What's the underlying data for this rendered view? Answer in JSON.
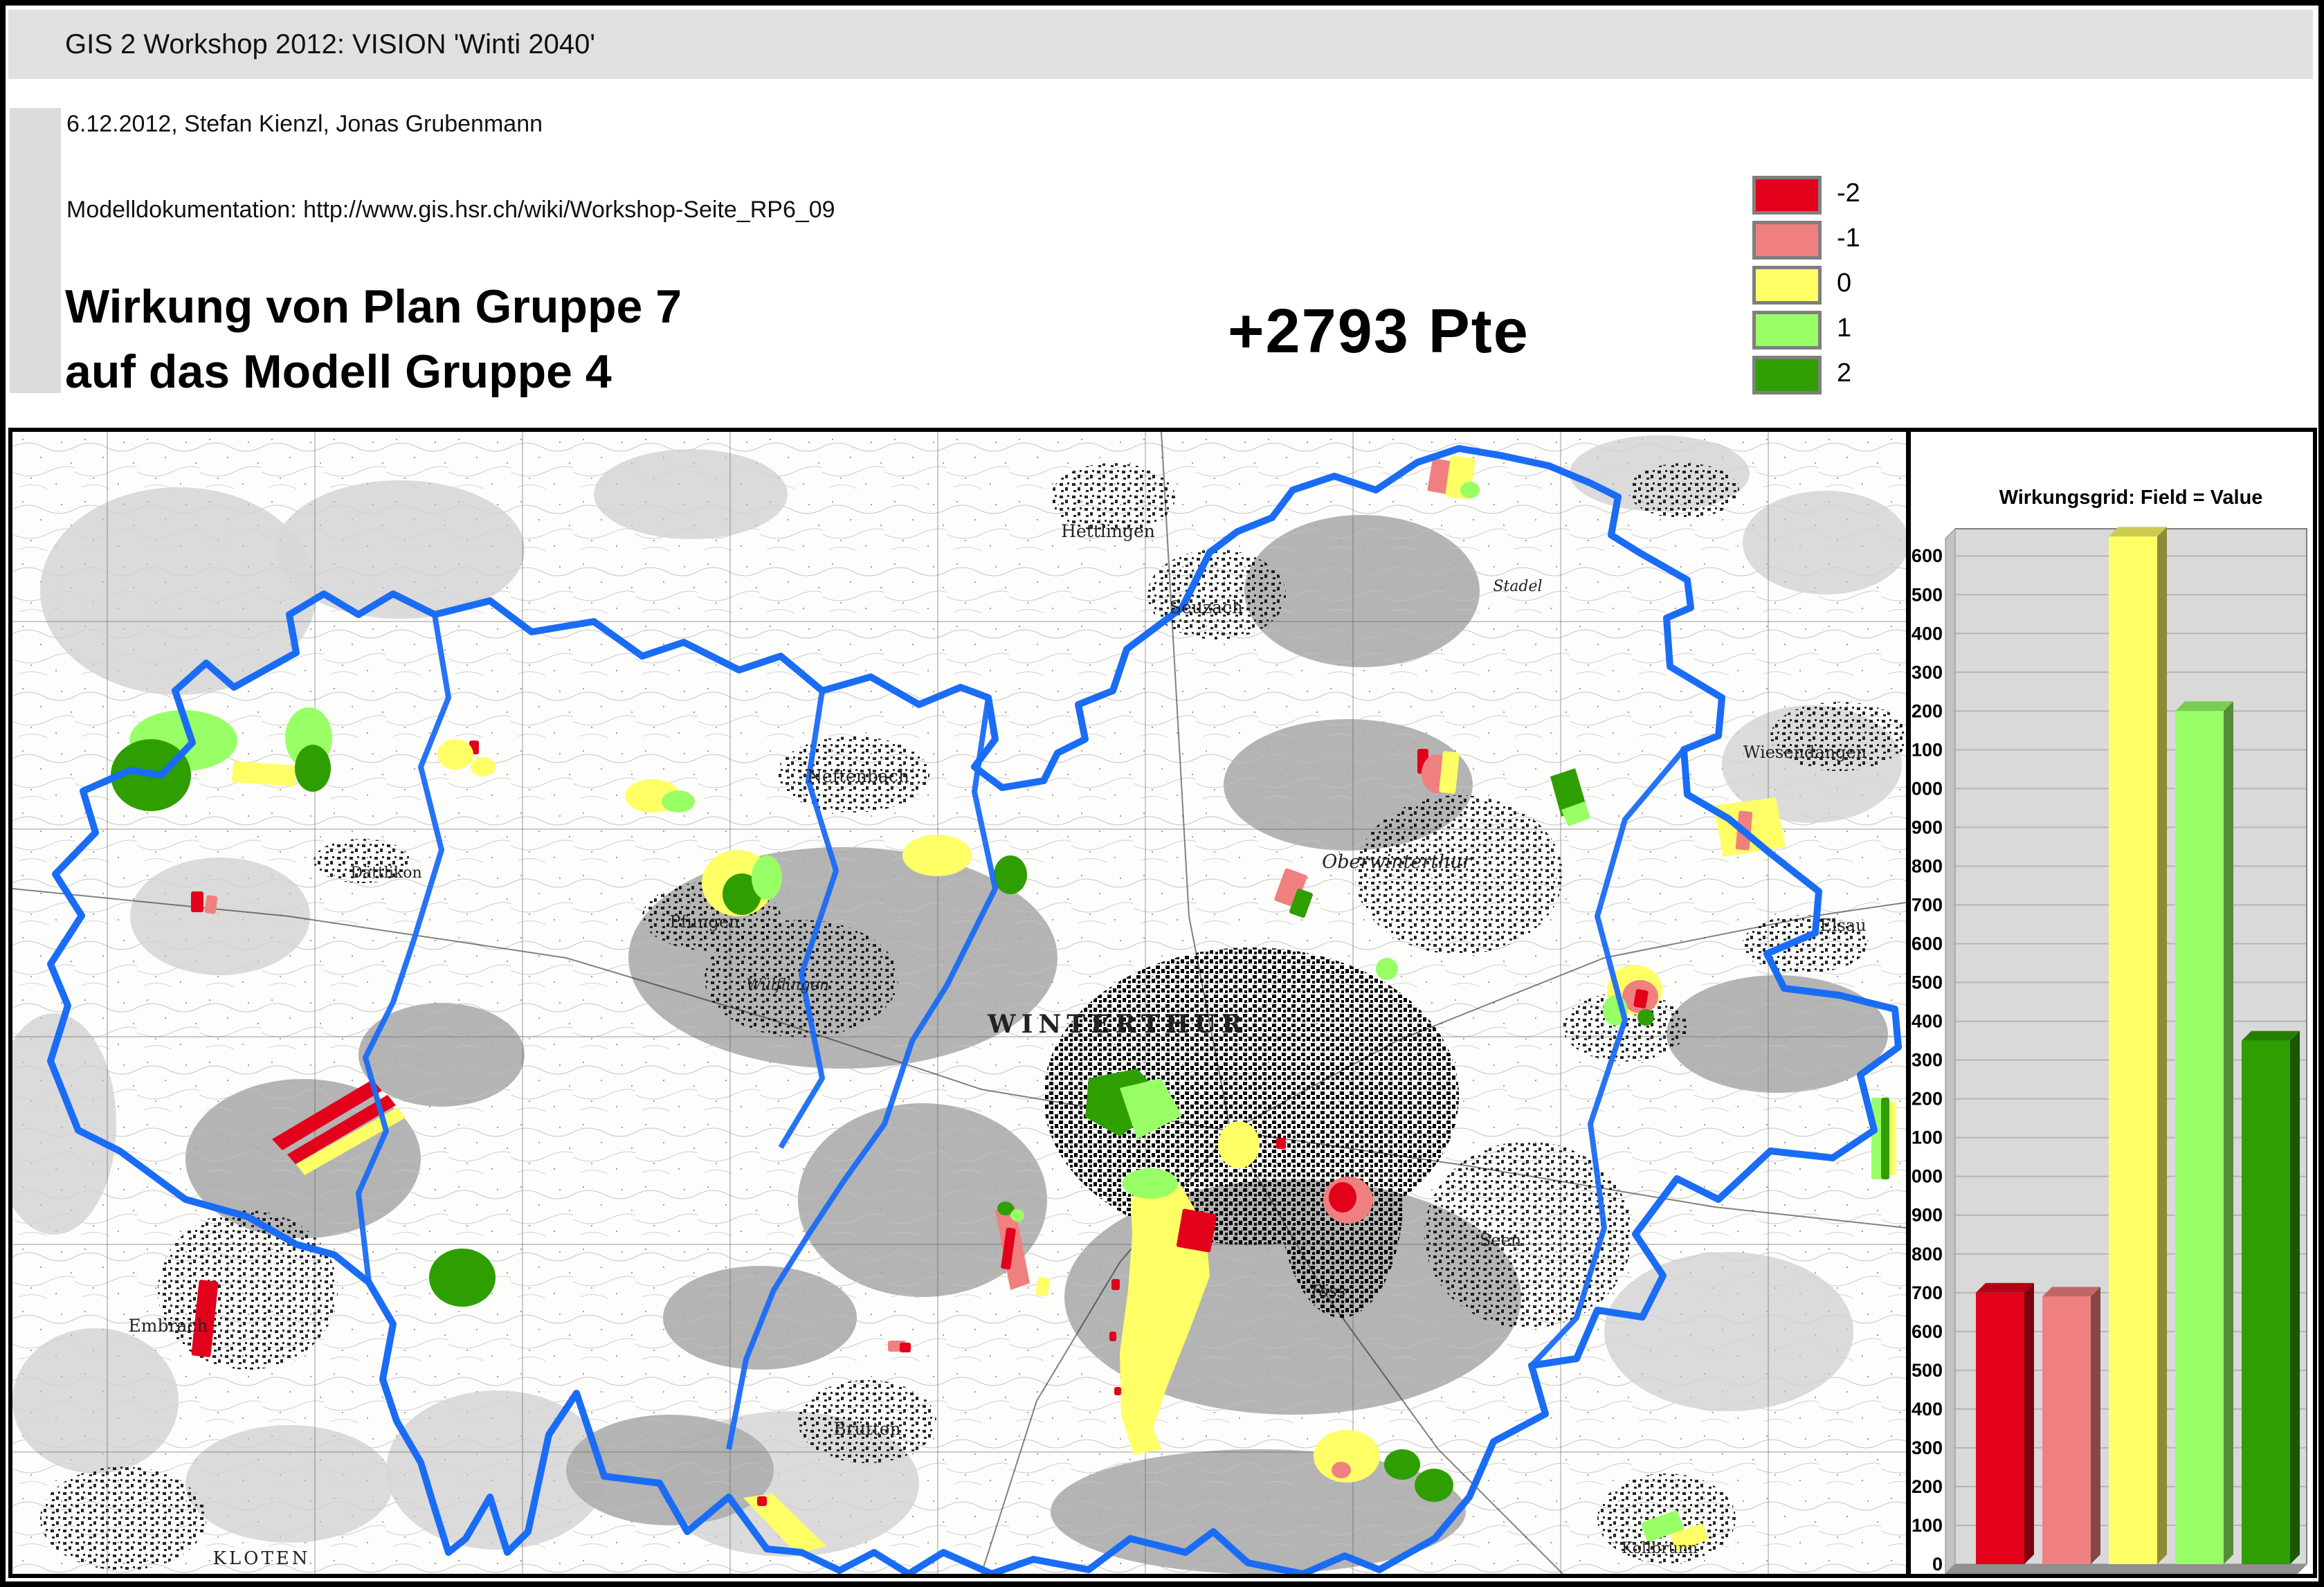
{
  "header": {
    "title": "GIS 2 Workshop 2012: VISION 'Winti 2040'",
    "subtitle": "6.12.2012, Stefan Kienzl, Jonas Grubenmann",
    "doc_line": "Modelldokumentation: http://www.gis.hsr.ch/wiki/Workshop-Seite_RP6_09",
    "main_title_line1": "Wirkung von Plan Gruppe 7",
    "main_title_line2": "auf das Modell Gruppe 4",
    "score": "+2793 Pte"
  },
  "legend": {
    "items": [
      {
        "label": "-2",
        "color": "#e2001a"
      },
      {
        "label": "-1",
        "color": "#f08080"
      },
      {
        "label": "0",
        "color": "#ffff66"
      },
      {
        "label": "1",
        "color": "#99ff66"
      },
      {
        "label": "2",
        "color": "#2f9e00"
      }
    ]
  },
  "map": {
    "boundary_color": "#1a6cf5",
    "city_labels": [
      {
        "name": "WINTERTHUR",
        "x": 1597,
        "y": 868,
        "size": 36,
        "caps": true,
        "spacing": 8
      },
      {
        "name": "Oberwinterthur",
        "x": 2000,
        "y": 630,
        "size": 27,
        "italic": true
      },
      {
        "name": "Seuzach",
        "x": 1725,
        "y": 262,
        "size": 25
      },
      {
        "name": "Hettlingen",
        "x": 1583,
        "y": 152,
        "size": 25
      },
      {
        "name": "Neftenbach",
        "x": 1222,
        "y": 506,
        "size": 25
      },
      {
        "name": "Dättlikon",
        "x": 540,
        "y": 644,
        "size": 22
      },
      {
        "name": "Pfungen",
        "x": 1000,
        "y": 716,
        "size": 24
      },
      {
        "name": "Wülflingen",
        "x": 1120,
        "y": 806,
        "size": 22,
        "italic": true
      },
      {
        "name": "Töss",
        "x": 1900,
        "y": 1250,
        "size": 24,
        "italic": true
      },
      {
        "name": "Seen",
        "x": 2150,
        "y": 1176,
        "size": 24
      },
      {
        "name": "Elsau",
        "x": 2645,
        "y": 721,
        "size": 24
      },
      {
        "name": "Wiesendangen",
        "x": 2590,
        "y": 471,
        "size": 24
      },
      {
        "name": "Brütten",
        "x": 1235,
        "y": 1449,
        "size": 25
      },
      {
        "name": "Embrach",
        "x": 225,
        "y": 1300,
        "size": 25
      },
      {
        "name": "KLOTEN",
        "x": 360,
        "y": 1636,
        "size": 26,
        "caps": true,
        "spacing": 4
      },
      {
        "name": "Kollbrunn",
        "x": 2380,
        "y": 1620,
        "size": 22
      },
      {
        "name": "Stadel",
        "x": 2175,
        "y": 230,
        "size": 22,
        "italic": true
      }
    ]
  },
  "chart_data": {
    "type": "bar",
    "title": "Wirkungsgrid: Field = Value",
    "categories": [
      "-2",
      "-1",
      "0",
      "1",
      "2"
    ],
    "values": [
      700,
      690,
      2650,
      2200,
      1350
    ],
    "bar_colors": [
      "#e2001a",
      "#f08080",
      "#ffff66",
      "#99ff66",
      "#2f9e00"
    ],
    "xlabel": "",
    "ylabel": "",
    "ylim": [
      0,
      2670
    ],
    "ytick_step": 100,
    "grid": true,
    "legend_position": "none",
    "style": "3d-column",
    "plot_background": "#d9d9d9"
  }
}
